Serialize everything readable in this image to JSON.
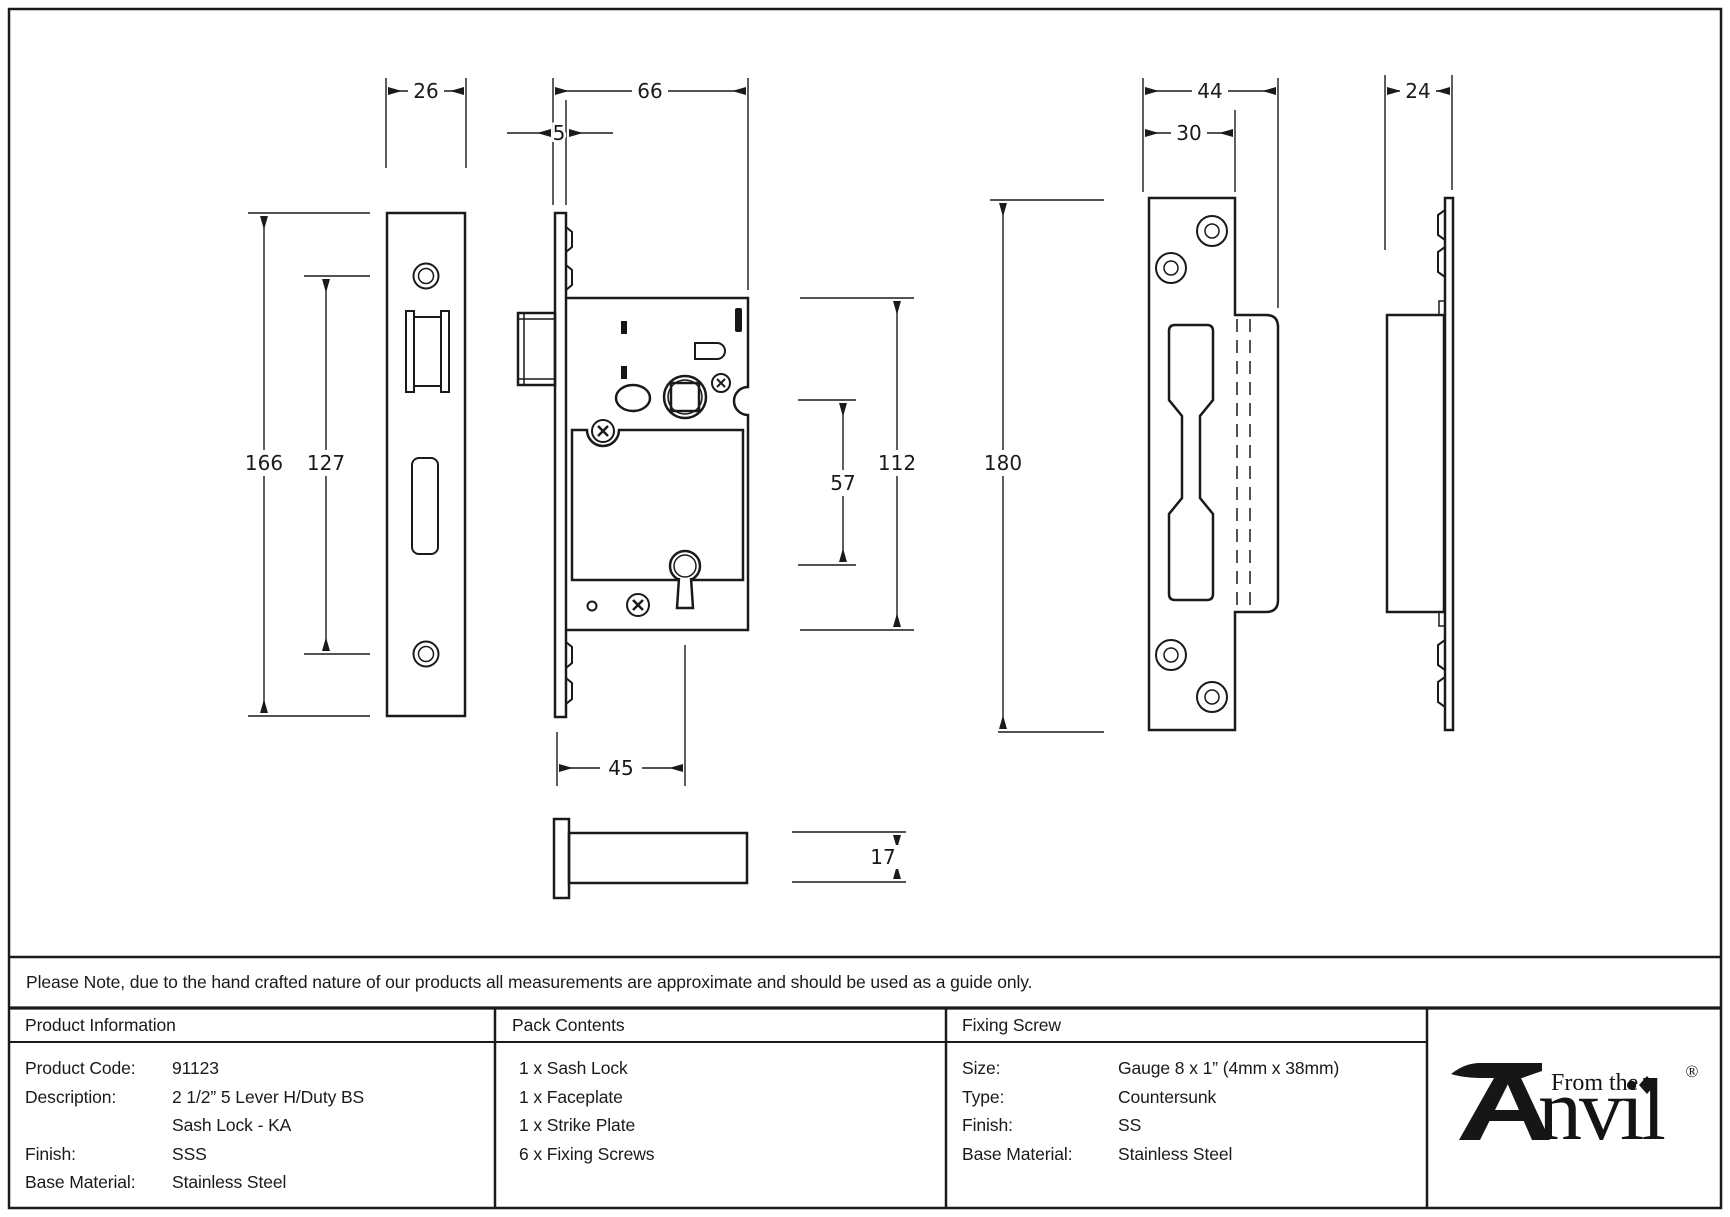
{
  "drawing": {
    "dims": {
      "d26": "26",
      "d66": "66",
      "d5": "5",
      "d166": "166",
      "d127": "127",
      "d45": "45",
      "d57": "57",
      "d112": "112",
      "d17": "17",
      "d180": "180",
      "d44": "44",
      "d30": "30",
      "d24": "24"
    }
  },
  "note": {
    "text": "Please Note, due to the hand crafted nature of our products all measurements are approximate and should be used as a guide only."
  },
  "table": {
    "product_information": {
      "header": "Product Information",
      "rows": [
        {
          "label": "Product Code:",
          "value": "91123"
        },
        {
          "label": "Description:",
          "value": "2 1/2” 5 Lever H/Duty BS"
        },
        {
          "label": "",
          "value": "Sash Lock - KA"
        },
        {
          "label": "Finish:",
          "value": "SSS"
        },
        {
          "label": "Base Material:",
          "value": "Stainless Steel"
        }
      ]
    },
    "pack_contents": {
      "header": "Pack Contents",
      "items": [
        "1 x Sash Lock",
        "1 x Faceplate",
        "1 x Strike Plate",
        "6 x Fixing Screws"
      ]
    },
    "fixing_screw": {
      "header": "Fixing Screw",
      "rows": [
        {
          "label": "Size:",
          "value": "Gauge 8 x 1” (4mm x 38mm)"
        },
        {
          "label": "Type:",
          "value": "Countersunk"
        },
        {
          "label": "Finish:",
          "value": "SS"
        },
        {
          "label": "Base Material:",
          "value": "Stainless Steel"
        }
      ]
    }
  },
  "logo": {
    "from_the": "From the",
    "name": "nvil",
    "registered": "®"
  }
}
